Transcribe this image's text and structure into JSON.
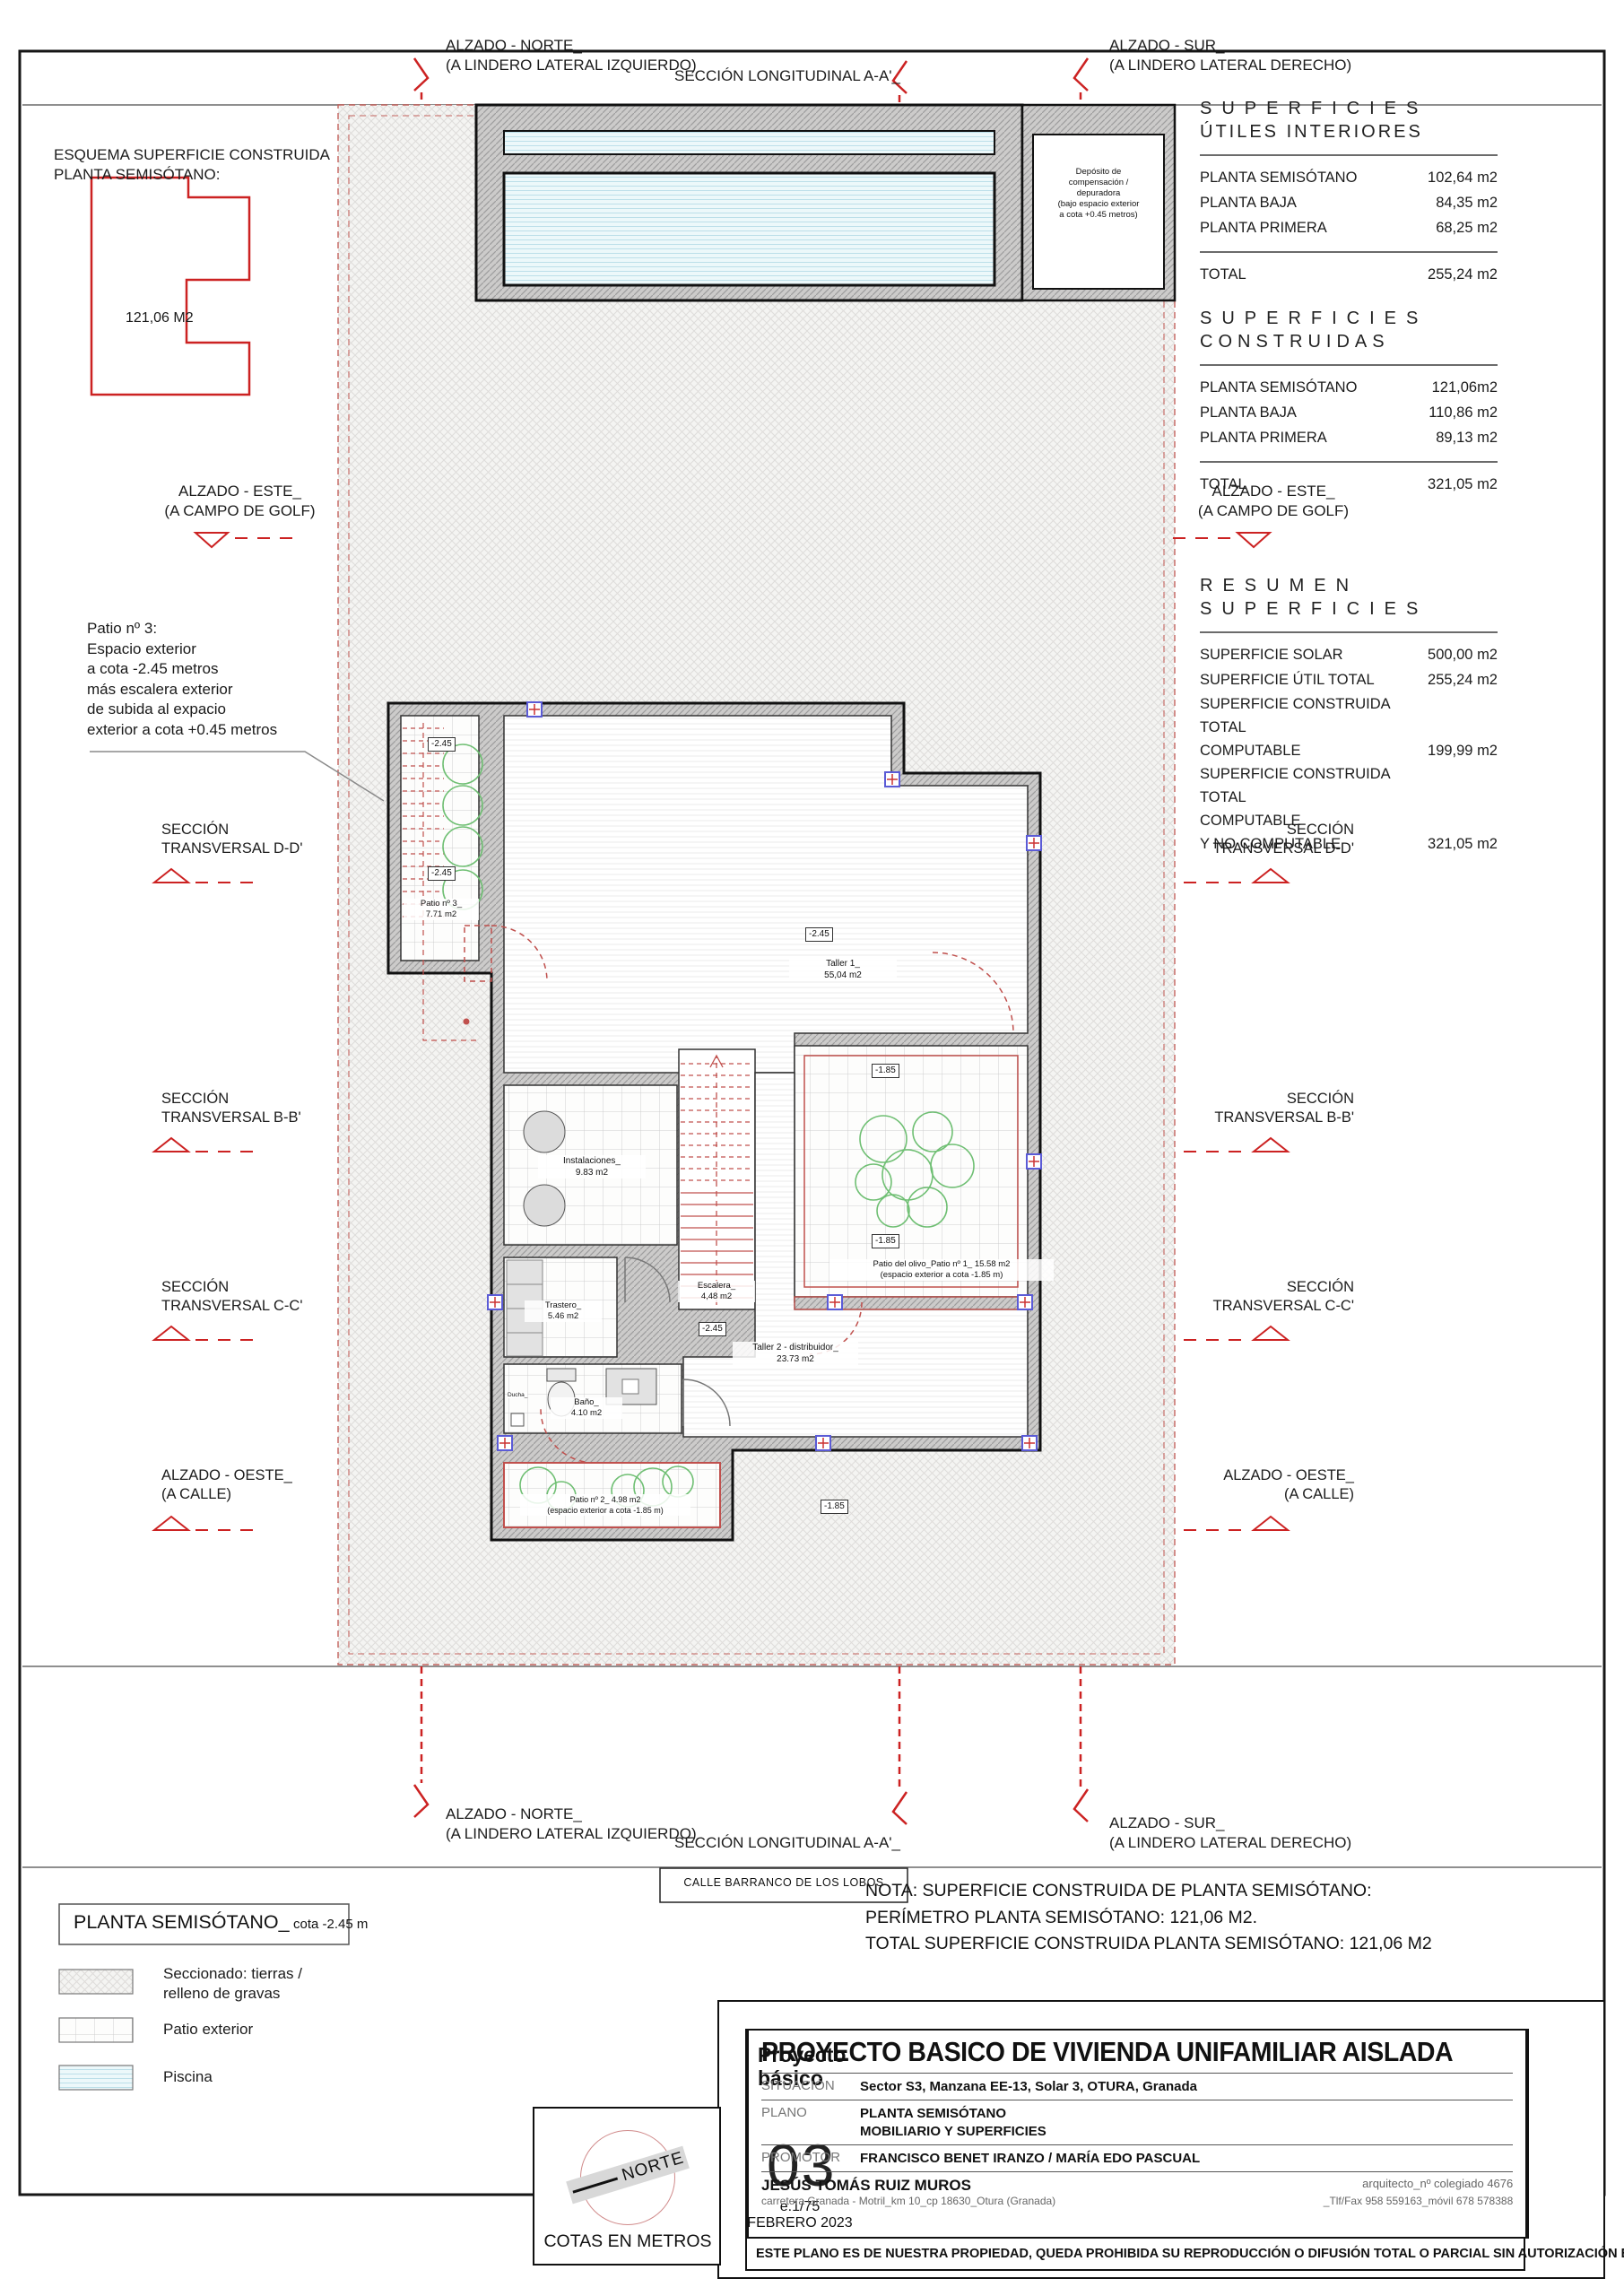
{
  "colors": {
    "red_accent": "#cc2222",
    "orange_brand": "#ef8b2d",
    "water_blue": "#d9eff4",
    "wall_gray": "#cccbca",
    "plant_green": "#6fbf73"
  },
  "edge_labels": {
    "alzado_norte_l1": "ALZADO  - NORTE_",
    "alzado_norte_l2": "(A LINDERO LATERAL IZQUIERDO)",
    "seccion_aa": "SECCIÓN LONGITUDINAL A-A'_",
    "alzado_sur_l1": "ALZADO  - SUR_",
    "alzado_sur_l2": "(A LINDERO LATERAL DERECHO)",
    "alzado_este_l1": "ALZADO  - ESTE_",
    "alzado_este_l2": "(A CAMPO DE GOLF)",
    "alzado_oeste_l1": "ALZADO  - OESTE_",
    "alzado_oeste_l2": "(A CALLE)",
    "seccion_l1": "SECCIÓN",
    "seccion_dd_l2": "TRANSVERSAL D-D'",
    "seccion_bb_l2": "TRANSVERSAL B-B'",
    "seccion_cc_l2": "TRANSVERSAL C-C'"
  },
  "esquema": {
    "line1": "ESQUEMA SUPERFICIE CONSTRUIDA",
    "line2": "PLANTA SEMISÓTANO:",
    "area": "121,06 M2"
  },
  "patio3_note": {
    "l1": "Patio nº 3:",
    "l2": "Espacio exterior",
    "l3": "a cota -2.45 metros",
    "l4": "más escalera exterior",
    "l5": "de subida al expacio",
    "l6": "exterior a cota +0.45 metros"
  },
  "right_column": {
    "tables": [
      {
        "title_line1": "SUPERFICIES",
        "title_line2": "ÚTILES INTERIORES",
        "rows": [
          {
            "label": "PLANTA SEMISÓTANO",
            "value": "102,64 m2"
          },
          {
            "label": "PLANTA BAJA",
            "value": "84,35 m2"
          },
          {
            "label": "PLANTA PRIMERA",
            "value": "68,25 m2"
          }
        ],
        "total_label": "TOTAL",
        "total_value": "255,24 m2"
      },
      {
        "title_line1": "SUPERFICIES",
        "title_line2": "CONSTRUIDAS",
        "rows": [
          {
            "label": "PLANTA SEMISÓTANO",
            "value": "121,06m2"
          },
          {
            "label": "PLANTA BAJA",
            "value": "110,86 m2"
          },
          {
            "label": "PLANTA PRIMERA",
            "value": "89,13 m2"
          }
        ],
        "total_label": "TOTAL",
        "total_value": "321,05 m2"
      },
      {
        "title_line1": "RESUMEN",
        "title_line2": "SUPERFICIES",
        "rows": [
          {
            "l1": "SUPERFICIE SOLAR",
            "value": "500,00 m2"
          },
          {
            "l1": "SUPERFICIE ÚTIL TOTAL",
            "value": "255,24 m2"
          },
          {
            "l1": "SUPERFICIE CONSTRUIDA TOTAL",
            "l2": "COMPUTABLE",
            "value": "199,99 m2"
          },
          {
            "l1": "SUPERFICIE CONSTRUIDA TOTAL",
            "l2": "COMPUTABLE",
            "l3": "Y NO COMPUTABLE",
            "value": "321,05 m2"
          }
        ]
      }
    ]
  },
  "plan": {
    "deposito": {
      "l1": "Depósito de",
      "l2": "compensación /",
      "l3": "depuradora",
      "l4": "(bajo espacio exterior",
      "l5": "a cota +0.45 metros)"
    },
    "cota_245": "-2.45",
    "cota_185": "-1.85",
    "patio3_name": "Patio nº 3_",
    "patio3_area": "7.71 m2",
    "taller1_name": "Taller 1_",
    "taller1_area": "55,04 m2",
    "instalaciones_name": "Instalaciones_",
    "instalaciones_area": "9.83 m2",
    "escalera_name": "Escalera_",
    "escalera_area": "4,48 m2",
    "trastero_name": "Trastero_",
    "trastero_area": "5.46 m2",
    "bano_name": "Baño_",
    "bano_area": "4.10 m2",
    "ducha": "Ducha_",
    "taller2_name": "Taller 2 - distribuidor_",
    "taller2_area": "23.73 m2",
    "patio_olivo_l1": "Patio del olivo_Patio nº 1_ 15.58 m2",
    "patio_olivo_l2": "(espacio exterior a cota -1.85 m)",
    "patio2_l1": "Patio nº 2_ 4.98 m2",
    "patio2_l2": "(espacio exterior a cota -1.85 m)"
  },
  "street": {
    "calle": "CALLE BARRANCO DE LOS LOBOS"
  },
  "nota": {
    "l1": "NOTA: SUPERFICIE CONSTRUIDA DE PLANTA SEMISÓTANO:",
    "l2": "PERÍMETRO PLANTA SEMISÓTANO: 121,06 M2.",
    "l3": "TOTAL SUPERFICIE CONSTRUIDA PLANTA SEMISÓTANO: 121,06 M2"
  },
  "legend": {
    "title": "PLANTA SEMISÓTANO_",
    "subtitle": "cota -2.45 m",
    "item1_l1": "Seccionado: tierras /",
    "item1_l2": "relleno de gravas",
    "item2": "Patio exterior",
    "item3": "Piscina"
  },
  "compass": {
    "norte": "NORTE",
    "cotas": "COTAS EN METROS"
  },
  "titleblock": {
    "proyecto_l1": "Proyecto",
    "proyecto_l2": "básico",
    "sheet_number": "03",
    "scale": "e.1/75",
    "date": "FEBRERO 2023",
    "title": "PROYECTO BASICO DE VIVIENDA UNIFAMILIAR AISLADA",
    "situacion_label": "SITUACIÓN",
    "situacion": "Sector S3, Manzana EE-13, Solar 3, OTURA, Granada",
    "plano_label": "PLANO",
    "plano_l1": "PLANTA SEMISÓTANO",
    "plano_l2": "MOBILIARIO Y SUPERFICIES",
    "promotor_label": "PROMOTOR",
    "promotor": "FRANCISCO BENET IRANZO / MARÍA EDO PASCUAL",
    "arquitecto": "JESÚS TOMÁS RUIZ MUROS",
    "colegiado": "arquitecto_nº colegiado 4676",
    "direccion": "carretera Granada - Motril_km 10_cp 18630_Otura (Granada)",
    "telefono": "_Tlf/Fax 958 559163_móvil 678 578388",
    "copyright": "ESTE PLANO ES DE NUESTRA PROPIEDAD, QUEDA PROHIBIDA SU REPRODUCCIÓN O DIFUSIÓN TOTAL O PARCIAL  SIN AUTORIZACIÓN ESCRITA",
    "logo_rm": "RM",
    "logo_a": "a",
    "logo_ruiz": "RUIZ",
    "logo_muros": "MUROS",
    "logo_arquitectos": "arquitectos"
  }
}
